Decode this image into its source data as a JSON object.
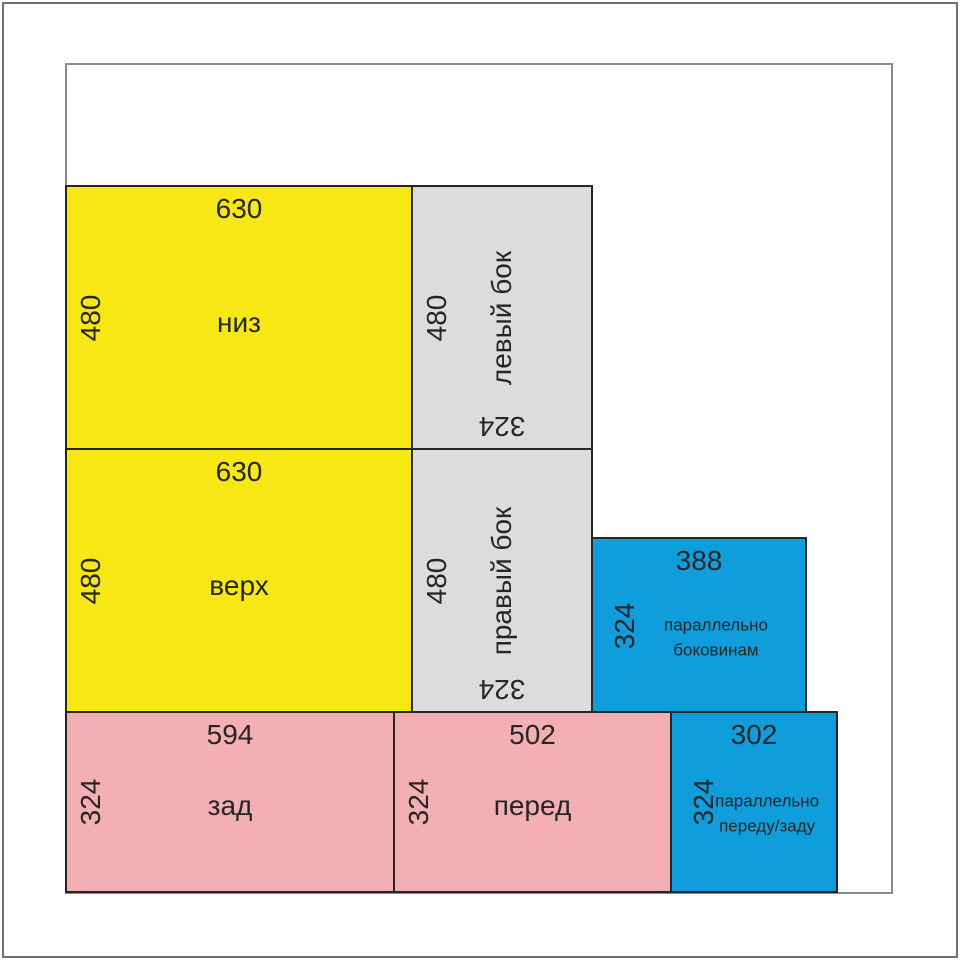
{
  "colors": {
    "panel_yellow": "#f7e715",
    "panel_gray": "#dcdcdc",
    "panel_blue": "#0f9ddb",
    "panel_pink": "#f4afb4",
    "panel_outline": "#262626",
    "sheet_border": "#8a8a8a",
    "frame_border": "#6e6e6e"
  },
  "panels": [
    {
      "name": "низ",
      "color": "yellow",
      "top_dim": "630",
      "side_dim": "480"
    },
    {
      "name": "левый бок",
      "color": "gray",
      "side_dim": "480",
      "bottom_dim": "324"
    },
    {
      "name": "верх",
      "color": "yellow",
      "top_dim": "630",
      "side_dim": "480"
    },
    {
      "name": "правый бок",
      "color": "gray",
      "side_dim": "480",
      "bottom_dim": "324"
    },
    {
      "name": "параллельно\nбоковинам",
      "color": "blue",
      "top_dim": "388",
      "side_dim": "324"
    },
    {
      "name": "зад",
      "color": "pink",
      "top_dim": "594",
      "side_dim": "324"
    },
    {
      "name": "перед",
      "color": "pink",
      "top_dim": "502",
      "side_dim": "324"
    },
    {
      "name": "параллельно\nпереду/заду",
      "color": "blue",
      "top_dim": "302",
      "side_dim": "324"
    }
  ]
}
